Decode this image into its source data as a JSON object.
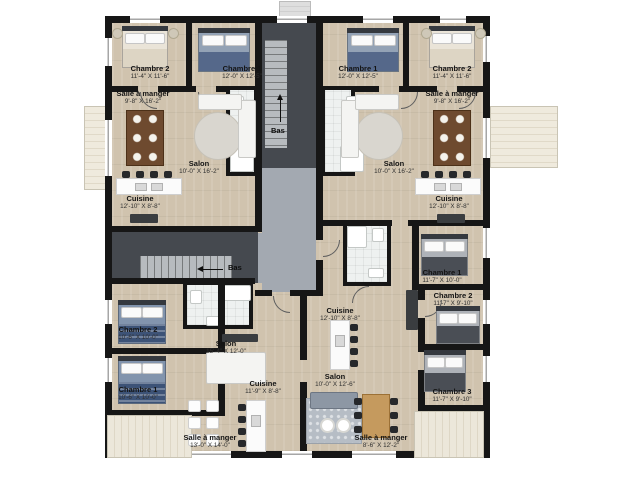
{
  "colors": {
    "wall": "#161616",
    "wood_floor": "#d0c3ae",
    "stairwell": "#45494f",
    "stair_treads": "#b7bbbf",
    "corridor": "#a3a9b1",
    "bathroom": "#eef1f0",
    "deck": "#e9e3d4",
    "bed_navy": "#55688a",
    "bed_cream": "#eae4d8"
  },
  "stairs": {
    "center": {
      "label": "Bas"
    },
    "west": {
      "label": "Bas"
    }
  },
  "rooms": {
    "tl_chambre2": {
      "name": "Chambre 2",
      "dims": "11'-4\" X 11'-6\""
    },
    "tl_chambre1": {
      "name": "Chambre 1",
      "dims": "12'-0\" X 12'-5\""
    },
    "tl_salle": {
      "name": "Salle à manger",
      "dims": "9'-8\" X 16'-2\""
    },
    "tl_salon": {
      "name": "Salon",
      "dims": "10'-0\" X 16'-2\""
    },
    "tl_cuisine": {
      "name": "Cuisine",
      "dims": "12'-10\" X 8'-8\""
    },
    "tr_chambre1": {
      "name": "Chambre 1",
      "dims": "12'-0\" X 12'-5\""
    },
    "tr_chambre2": {
      "name": "Chambre 2",
      "dims": "11'-4\" X 11'-6\""
    },
    "tr_salle": {
      "name": "Salle à manger",
      "dims": "9'-8\" X 16'-2\""
    },
    "tr_salon": {
      "name": "Salon",
      "dims": "10'-0\" X 16'-2\""
    },
    "tr_cuisine": {
      "name": "Cuisine",
      "dims": "12'-10\" X 8'-8\""
    },
    "bl_chambre2": {
      "name": "Chambre 2",
      "dims": "10'-6\" X 10'-0\""
    },
    "bl_chambre1": {
      "name": "Chambre 1",
      "dims": "10'-6\" X 10'-0\""
    },
    "bl_salon": {
      "name": "Salon",
      "dims": "15'-4\" X 12'-0\""
    },
    "bl_cuisine": {
      "name": "Cuisine",
      "dims": "11'-9\" X 8'-8\""
    },
    "bl_salle": {
      "name": "Salle à manger",
      "dims": "13'-0\" X 14'-0\""
    },
    "br_cuisine": {
      "name": "Cuisine",
      "dims": "12'-10\" X 8'-8\""
    },
    "br_salon": {
      "name": "Salon",
      "dims": "10'-0\" X 12'-6\""
    },
    "br_salle": {
      "name": "Salle à manger",
      "dims": "8'-6\" X 12'-2\""
    },
    "br_chambre1": {
      "name": "Chambre 1",
      "dims": "11'-7\" X 10'-0\""
    },
    "br_chambre2": {
      "name": "Chambre 2",
      "dims": "11'-7\" X 9'-10\""
    },
    "br_chambre3": {
      "name": "Chambre 3",
      "dims": "11'-7\" X 9'-10\""
    }
  }
}
